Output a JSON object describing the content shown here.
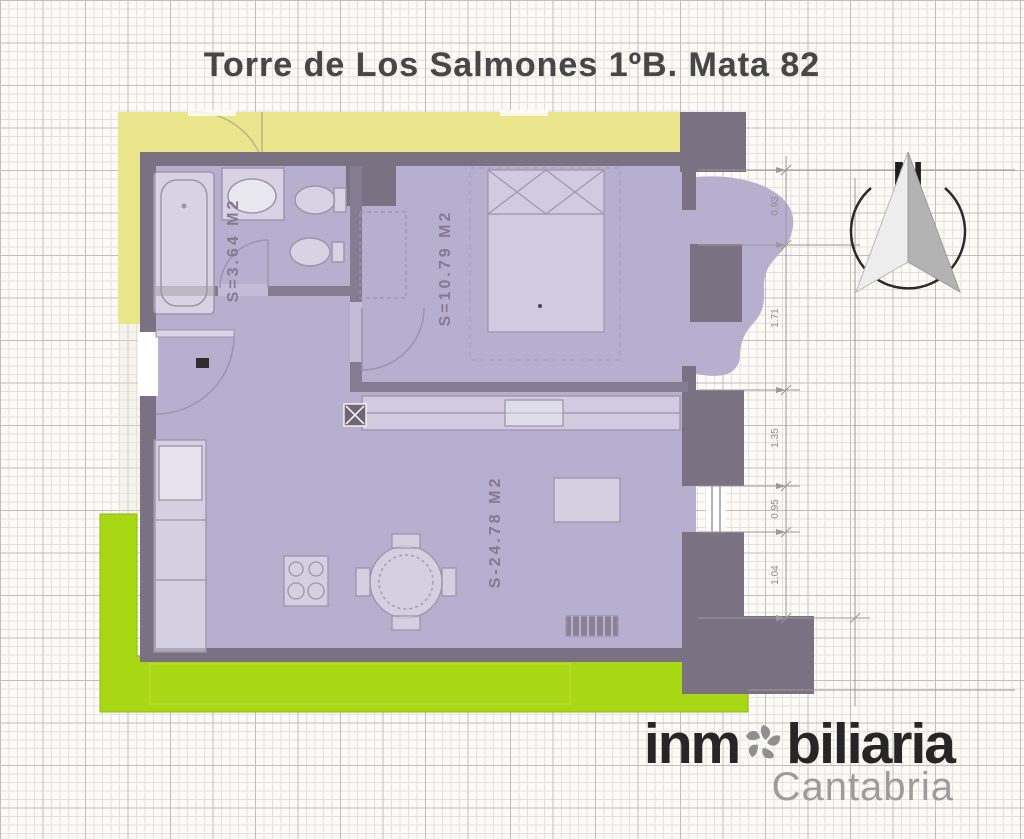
{
  "title": "Torre de Los Salmones 1ºB. Mata 82",
  "compass": {
    "label": "N"
  },
  "plan": {
    "rooms": [
      {
        "name": "bathroom",
        "area_label": "S=3.64 M2"
      },
      {
        "name": "bedroom",
        "area_label": "S=10.79 M2"
      },
      {
        "name": "living-kitchen",
        "area_label": "S-24.78 M2"
      }
    ],
    "dimensions": {
      "right": [
        "0.93",
        "1.71",
        "1.35",
        "0.95",
        "1.04"
      ]
    }
  },
  "brand": {
    "prefix": "inm",
    "suffix": "biliaria",
    "region": "Cantabria"
  },
  "colors": {
    "floor": "#b7afce",
    "walls": "#7a7183",
    "corridor": "#ebe58b",
    "terrace": "#a8d714",
    "logo_dark": "#262626",
    "logo_light": "#9c9c9c"
  }
}
